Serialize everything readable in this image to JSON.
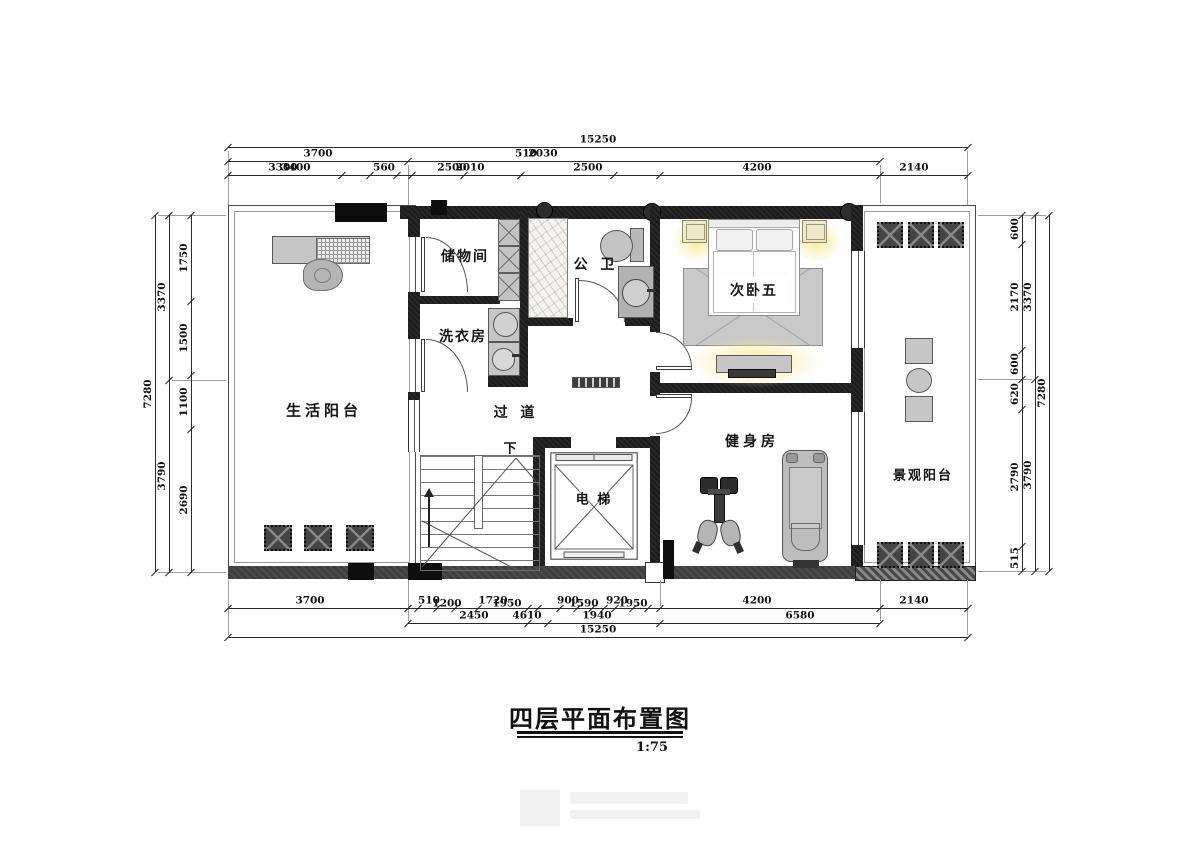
{
  "title": {
    "text": "四层平面布置图",
    "scale": "1:75"
  },
  "room_labels": [
    {
      "t": "生活阳台",
      "x": 324,
      "y": 410,
      "fs": 15,
      "ls": 4,
      "name": "room-label-living-balcony"
    },
    {
      "t": "储物间",
      "x": 465,
      "y": 256,
      "fs": 14,
      "ls": 2,
      "name": "room-label-storage"
    },
    {
      "t": "洗衣房",
      "x": 463,
      "y": 336,
      "fs": 14,
      "ls": 2,
      "name": "room-label-laundry"
    },
    {
      "t": "公 卫",
      "x": 596,
      "y": 264,
      "fs": 14,
      "ls": 4,
      "name": "room-label-bathroom"
    },
    {
      "t": "次卧五",
      "x": 754,
      "y": 290,
      "fs": 14,
      "ls": 2,
      "boxed": true,
      "name": "room-label-bedroom5"
    },
    {
      "t": "过 道",
      "x": 516,
      "y": 412,
      "fs": 14,
      "ls": 4,
      "name": "room-label-corridor"
    },
    {
      "t": "下",
      "x": 510,
      "y": 447,
      "fs": 13,
      "ls": 0,
      "name": "stair-down-label"
    },
    {
      "t": "电 梯",
      "x": 594,
      "y": 498,
      "fs": 13,
      "ls": 2,
      "halo": true,
      "name": "room-label-elevator"
    },
    {
      "t": "健身房",
      "x": 752,
      "y": 441,
      "fs": 14,
      "ls": 4,
      "name": "room-label-gym"
    },
    {
      "t": "景观阳台",
      "x": 923,
      "y": 474,
      "fs": 13,
      "ls": 2,
      "name": "room-label-view-balcony"
    }
  ],
  "dim_rows": [
    {
      "y": 147,
      "x1": 228,
      "x2": 968,
      "ticks": [
        228,
        968
      ],
      "labels": [
        {
          "t": "15250",
          "x": 598
        }
      ]
    },
    {
      "y": 161,
      "x1": 228,
      "x2": 880,
      "ticks": [
        228,
        408,
        880
      ],
      "labels": [
        {
          "t": "3700",
          "x": 318
        },
        {
          "t": "510",
          "x": 526
        },
        {
          "t": "2030",
          "x": 543
        }
      ]
    },
    {
      "y": 175,
      "x1": 228,
      "x2": 968,
      "ticks": [
        228,
        342,
        370,
        397,
        412,
        464,
        521,
        614,
        660,
        880,
        968
      ],
      "labels": [
        {
          "t": "3300",
          "x": 283
        },
        {
          "t": "3400",
          "x": 296
        },
        {
          "t": "560",
          "x": 384
        },
        {
          "t": "2500",
          "x": 452
        },
        {
          "t": "2010",
          "x": 470
        },
        {
          "t": "2500",
          "x": 588
        },
        {
          "t": "4200",
          "x": 757
        },
        {
          "t": "2140",
          "x": 914
        }
      ]
    },
    {
      "y": 608,
      "x1": 228,
      "x2": 968,
      "ticks": [
        228,
        408,
        418,
        437,
        455,
        478,
        528,
        538,
        560,
        577,
        592,
        604,
        615,
        633,
        648,
        660,
        880,
        968
      ],
      "labels": [
        {
          "t": "3700",
          "x": 310
        },
        {
          "t": "510",
          "x": 429
        },
        {
          "t": "1200",
          "x": 447,
          "dy": 3
        },
        {
          "t": "1720",
          "x": 493
        },
        {
          "t": "1950",
          "x": 507,
          "dy": 3
        },
        {
          "t": "900",
          "x": 568
        },
        {
          "t": "1590",
          "x": 584,
          "dy": 3
        },
        {
          "t": "920",
          "x": 617
        },
        {
          "t": "1950",
          "x": 633,
          "dy": 3
        },
        {
          "t": "4200",
          "x": 757
        },
        {
          "t": "2140",
          "x": 914
        }
      ]
    },
    {
      "y": 623,
      "x1": 408,
      "x2": 880,
      "ticks": [
        408,
        528,
        548,
        660,
        880
      ],
      "labels": [
        {
          "t": "2450",
          "x": 474
        },
        {
          "t": "4610",
          "x": 527
        },
        {
          "t": "1940",
          "x": 597
        },
        {
          "t": "6580",
          "x": 800
        }
      ]
    },
    {
      "y": 637,
      "x1": 228,
      "x2": 968,
      "ticks": [
        228,
        968
      ],
      "labels": [
        {
          "t": "15250",
          "x": 598
        }
      ]
    }
  ],
  "dim_cols": [
    {
      "x": 155,
      "y1": 215,
      "y2": 572,
      "ticks": [
        215,
        572
      ],
      "labels": [
        {
          "t": "7280",
          "y": 394
        }
      ]
    },
    {
      "x": 169,
      "y1": 215,
      "y2": 572,
      "ticks": [
        215,
        380,
        572
      ],
      "labels": [
        {
          "t": "3370",
          "y": 297
        },
        {
          "t": "3790",
          "y": 476
        }
      ]
    },
    {
      "x": 191,
      "y1": 215,
      "y2": 572,
      "ticks": [
        215,
        301,
        375,
        429,
        572
      ],
      "labels": [
        {
          "t": "1750",
          "y": 258
        },
        {
          "t": "1500",
          "y": 338
        },
        {
          "t": "1100",
          "y": 402
        },
        {
          "t": "2690",
          "y": 500
        }
      ]
    },
    {
      "x": 1022,
      "y1": 215,
      "y2": 571,
      "ticks": [
        215,
        244,
        350,
        379,
        409,
        546,
        571
      ],
      "labels": [
        {
          "t": "600",
          "y": 229
        },
        {
          "t": "2170",
          "y": 297
        },
        {
          "t": "600",
          "y": 364
        },
        {
          "t": "620",
          "y": 394
        },
        {
          "t": "2790",
          "y": 477
        },
        {
          "t": "515",
          "y": 558
        }
      ]
    },
    {
      "x": 1035,
      "y1": 215,
      "y2": 571,
      "ticks": [
        215,
        379,
        571
      ],
      "labels": [
        {
          "t": "3370",
          "y": 297
        },
        {
          "t": "3790",
          "y": 475
        }
      ]
    },
    {
      "x": 1049,
      "y1": 215,
      "y2": 571,
      "ticks": [
        215,
        571
      ],
      "labels": [
        {
          "t": "7280",
          "y": 393
        }
      ]
    }
  ]
}
